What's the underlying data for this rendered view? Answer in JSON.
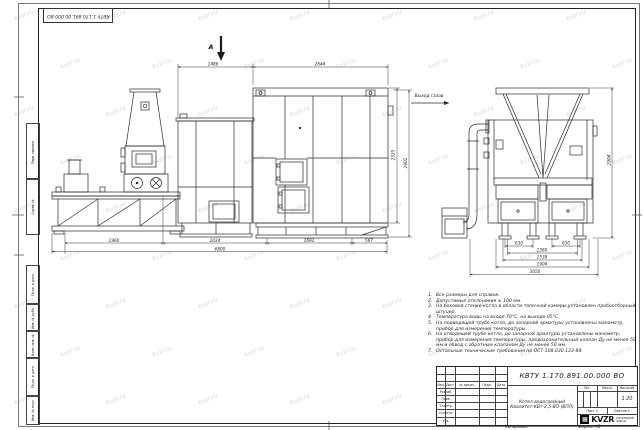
{
  "watermark": {
    "text": "kvzr.ru"
  },
  "corner_stamp": {
    "doc_number": "КВТУ 1.170.891.00.000 ВО"
  },
  "margin_stamps": {
    "top": [
      "Перв. примен.",
      "Справ. №"
    ],
    "bottom": [
      "Подп. и дата",
      "Инв. № дубл.",
      "Взам. инв. №",
      "Подп. и дата",
      "Инв. № подл."
    ]
  },
  "views": {
    "section_arrow_label": "А",
    "gas_outlet_label": "Выход газов"
  },
  "dims": {
    "front": {
      "top_left": "1486",
      "top_right": "2644",
      "height_inner": "2335",
      "height_outer": "2902",
      "bottom_1": "1960",
      "bottom_2": "2034",
      "bottom_3": "1692",
      "bottom_4": "567",
      "bottom_total": "6800"
    },
    "side": {
      "hopper_left": "630",
      "hopper_right": "630",
      "width_1": "1360",
      "width_2": "1538",
      "width_3": "1904",
      "width_total": "3050",
      "height": "2904"
    }
  },
  "notes": {
    "items": [
      {
        "num": "1.",
        "text": "Все размеры для справок."
      },
      {
        "num": "2.",
        "text": "Допустимые отклонения ± 100 мм."
      },
      {
        "num": "3.",
        "text": "На боковой стенке котла в области топочной камеры установлен пробоотборный штуцер."
      },
      {
        "num": "4.",
        "text": "Температура воды на входе 70°С, на выходе 95°С."
      },
      {
        "num": "5.",
        "text": "На подводящей трубе котла, до запорной арматуры установлены манометр, прибор для измерения температуры."
      },
      {
        "num": "6.",
        "text": "На отводящей трубе котла, до запорной арматуры установлены манометр, прибор для измерения температуры, предохранительный клапан Ду не менее 50 мм и обвод с обратным клапаном Ду не менее 50 мм."
      },
      {
        "num": "7.",
        "text": "Остальные технические требования по ОСТ 108.030.133-84."
      }
    ]
  },
  "title_block": {
    "doc_number": "КВТУ 1.170.891.00.000 ВО",
    "title_line1": "Котел водогрейный",
    "title_line2": "Квалитет-КВт-2,5-ВО-(ВПЛ)",
    "header": {
      "izm": "Изм.",
      "list": "Лист",
      "doc": "№ докум.",
      "podp": "Подп.",
      "data": "Дата"
    },
    "rows": [
      "Разраб.",
      "Пров.",
      "Т.контр.",
      "Н.контр.",
      "Утв."
    ],
    "lit_label": "Лит.",
    "mass_label": "Масса",
    "scale_label": "Масштаб",
    "scale_value": "1:20",
    "sheet_text": "Лист 1",
    "sheets_text": "Листов 1",
    "company": {
      "logo_mark": "▦",
      "logo_word": "KVZR",
      "tagline1": "КОТЕЛЬНЫЙ",
      "tagline2": "ЗАВОД"
    }
  },
  "footer": {
    "left": "Копировал",
    "right": "Формат А2"
  }
}
